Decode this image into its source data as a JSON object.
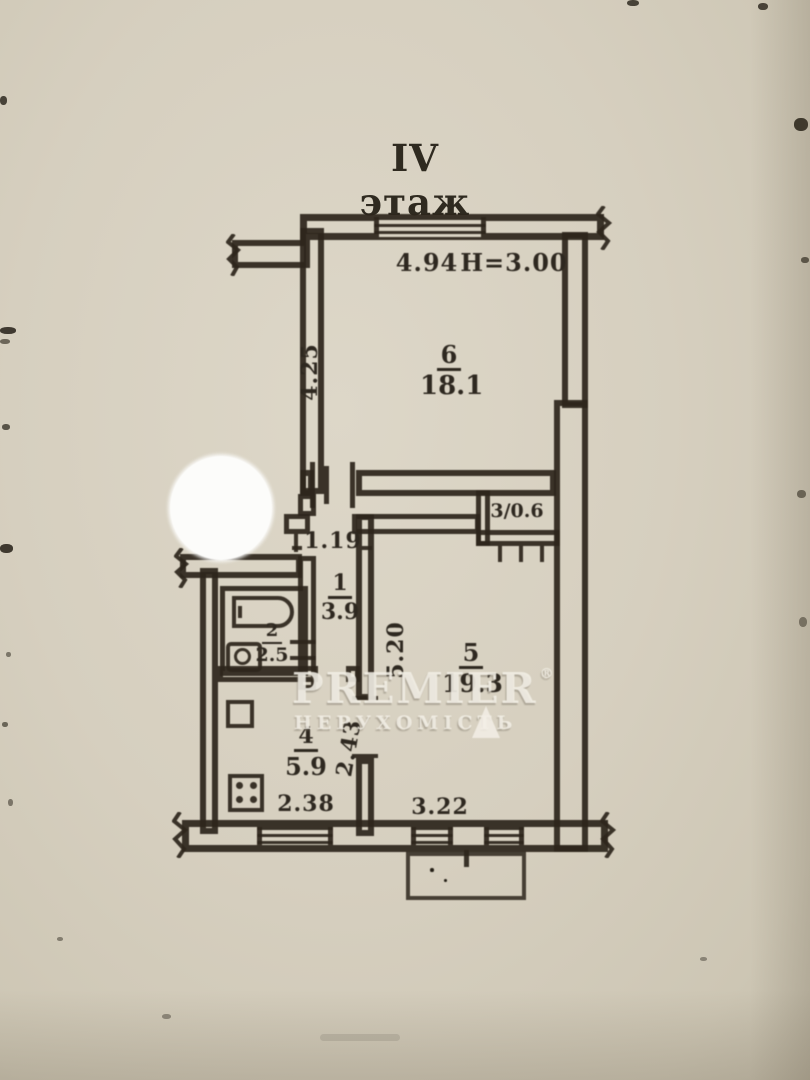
{
  "title": "IV этаж",
  "plan": {
    "room6": {
      "number": "6",
      "area": "18.1",
      "width": "4.94",
      "height_note": "Н=3.00",
      "depth": "4.25"
    },
    "closet": {
      "label": "3/0.6"
    },
    "hall": {
      "number": "1",
      "area": "3.9",
      "door_width": "1.19"
    },
    "bath": {
      "number": "2",
      "area": "2.5"
    },
    "kitchen": {
      "number": "4",
      "area": "5.9",
      "width": "2.38",
      "depth": "2.43"
    },
    "room5": {
      "number": "5",
      "area": "19.3",
      "depth": "5.20",
      "window_width": "3.22"
    }
  },
  "watermark": {
    "brand": "PREMIER",
    "registered": "®",
    "subtitle": "НЕРУХОМІСТЬ"
  },
  "colors": {
    "paper": "#d8d1c1",
    "ink": "#2d261c",
    "stamp_circle": "#fcfcfa",
    "watermark": "#f3efe6"
  }
}
